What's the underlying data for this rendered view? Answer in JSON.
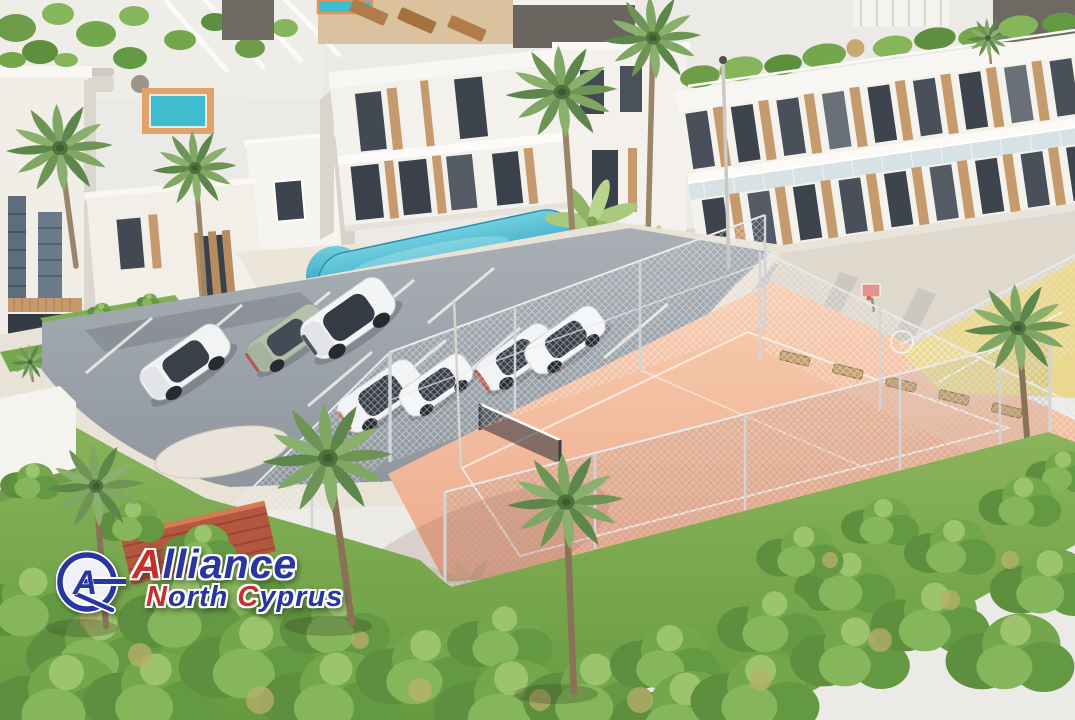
{
  "watermark": {
    "brand": "Alliance",
    "brand_initial": "A",
    "brand_rest": "lliance",
    "region": "North Cyprus",
    "region_word1_initial": "N",
    "region_word1_rest": "orth",
    "region_word2_initial": "C",
    "region_word2_rest": "yprus",
    "monogram": "A"
  },
  "palette": {
    "pool_water": "#3db6cc",
    "tennis_clay": "#f2b79b",
    "sports_court_yellow": "#e9d88e",
    "asphalt": "#9aa1a8",
    "sidewalk": "#e7e1d6",
    "lawn": "#7fae53",
    "foliage_dark": "#4f7a38",
    "building_white": "#f7f5f1",
    "wood_accent": "#c69a6d",
    "window_glass": "#3c424a",
    "roof_tile": "#b5573f",
    "logo_blue": "#2a36a0",
    "logo_red": "#c5302c"
  },
  "scene": {
    "description": "Aerial 3D architectural rendering of a Mediterranean residential complex with white villas, rooftop terraces, a curved swimming pool, palm trees, a parking lot with cars, and a fenced tennis court",
    "features": [
      "white villas with rooftop garden terraces",
      "apartment block with wood-slat facade and glass balustrade",
      "curved turquoise swimming pool",
      "rooftop plunge pool with orange deck",
      "parking lot with marked stalls",
      "chain-link fenced clay tennis court with net",
      "yellow basketball court with hoop",
      "benches along the court fence",
      "palm trees and banana plants",
      "dense garden shrubs and lawn",
      "terracotta tiled roof"
    ],
    "vehicles": [
      {
        "label": "white SUV"
      },
      {
        "label": "sage green sedan"
      },
      {
        "label": "white SUV"
      },
      {
        "label": "white crossover"
      },
      {
        "label": "white sedan"
      },
      {
        "label": "white hatchback"
      },
      {
        "label": "white SUV"
      }
    ]
  }
}
